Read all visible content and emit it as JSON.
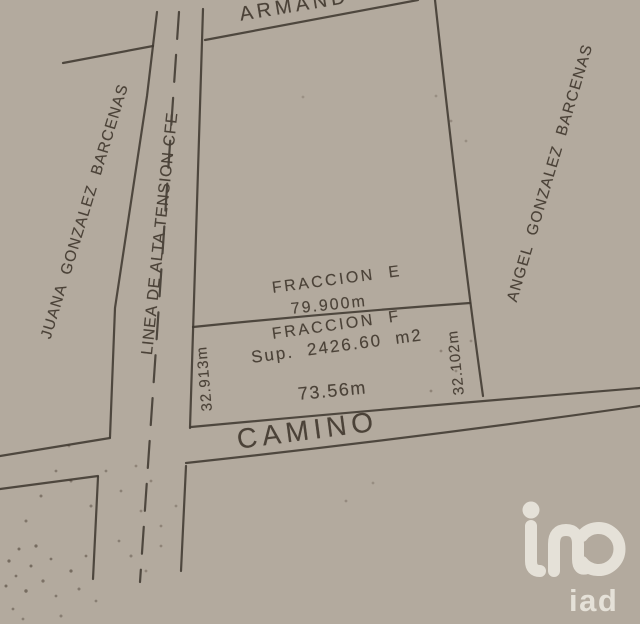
{
  "plan": {
    "adjoining_owners": {
      "top": "ARMAND",
      "left": "JUANA  GONZALEZ  BARCENAS",
      "right": "ANGEL  GONZALEZ  BARCENAS"
    },
    "utility_line_label": "LINEA DE ALTA TENSION CFE",
    "road_label": "CAMINO",
    "fraction_e": {
      "label": "FRACCION  E",
      "boundary_length": "79.900m"
    },
    "fraction_f": {
      "label": "FRACCION  F",
      "area": "Sup.  2426.60  m2",
      "front_length": "73.56m",
      "west_side_length": "32.913m",
      "east_side_length": "32.102m"
    }
  },
  "watermark": {
    "brand": "iad"
  },
  "colors": {
    "ink": "#403931",
    "paper": "#b3aa9e",
    "watermark": "#e9e5dc"
  }
}
